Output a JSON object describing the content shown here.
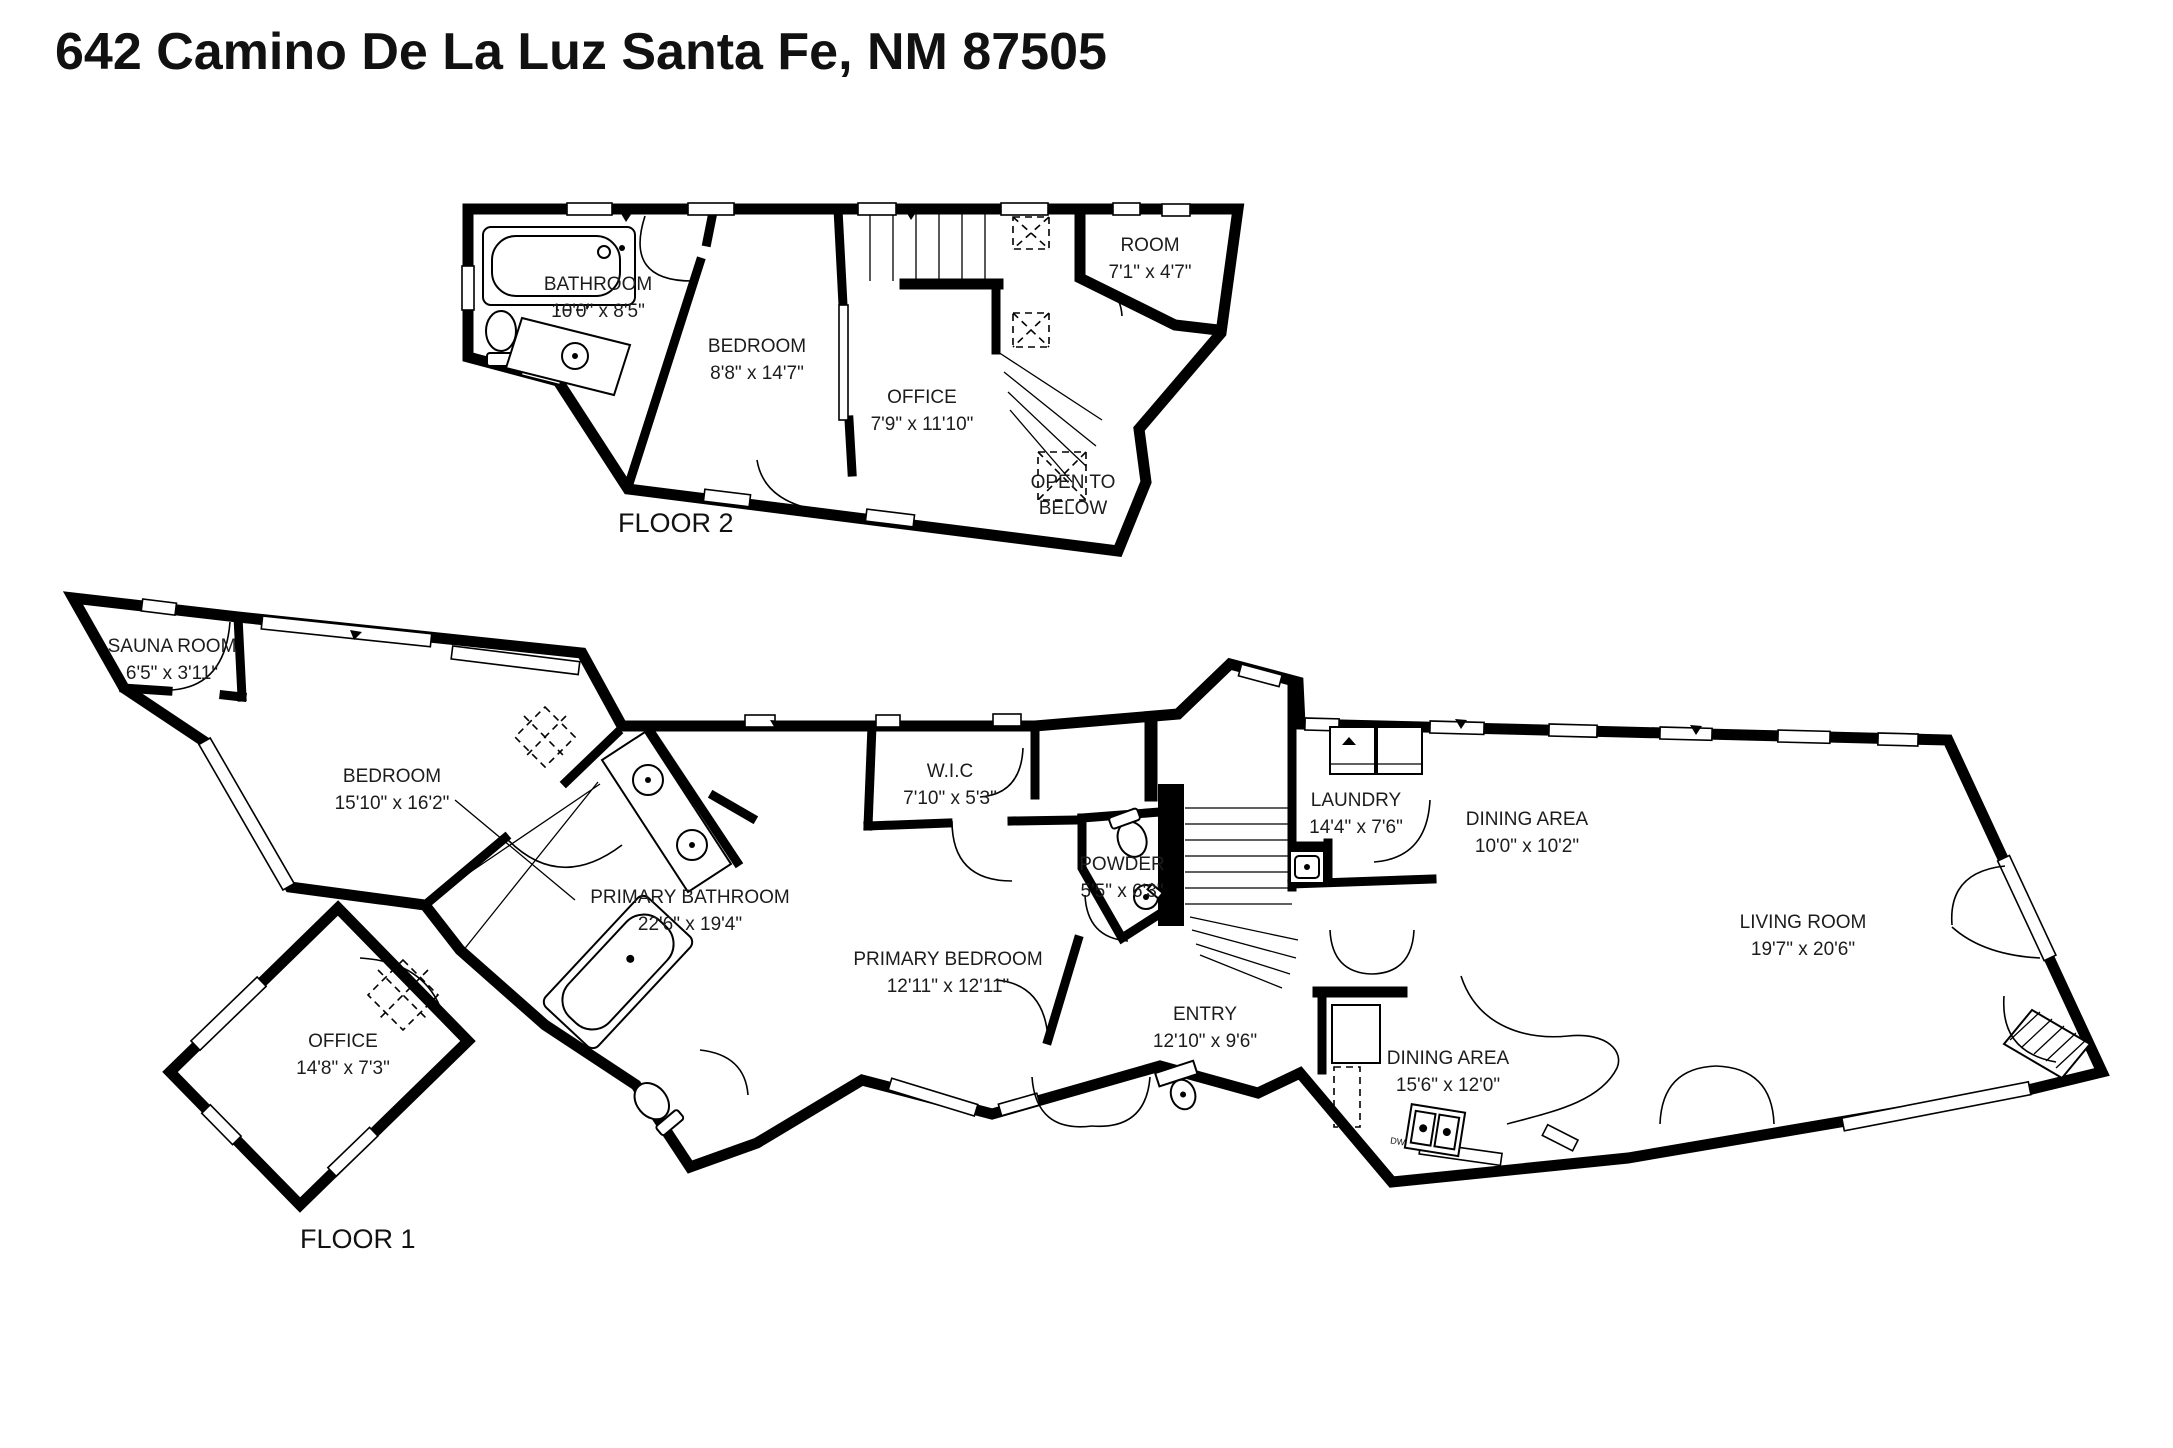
{
  "title": "642 Camino De La Luz Santa Fe, NM 87505",
  "floors": [
    {
      "label": "FLOOR 2",
      "rooms": [
        {
          "name": "BATHROOM",
          "dims": "10'0\" x 8'5\""
        },
        {
          "name": "BEDROOM",
          "dims": "8'8\" x 14'7\""
        },
        {
          "name": "OFFICE",
          "dims": "7'9\" x 11'10\""
        },
        {
          "name": "ROOM",
          "dims": "7'1\" x 4'7\""
        }
      ],
      "annotations": [
        {
          "line1": "OPEN TO",
          "line2": "BELOW"
        }
      ]
    },
    {
      "label": "FLOOR 1",
      "rooms": [
        {
          "name": "SAUNA ROOM",
          "dims": "6'5\" x 3'11\""
        },
        {
          "name": "BEDROOM",
          "dims": "15'10\" x 16'2\""
        },
        {
          "name": "PRIMARY BATHROOM",
          "dims": "22'6\" x 19'4\""
        },
        {
          "name": "OFFICE",
          "dims": "14'8\" x 7'3\""
        },
        {
          "name": "W.I.C",
          "dims": "7'10\" x 5'3\""
        },
        {
          "name": "PRIMARY BEDROOM",
          "dims": "12'11\" x 12'11\""
        },
        {
          "name": "POWDER",
          "dims": "5'5\" x 6'3\""
        },
        {
          "name": "ENTRY",
          "dims": "12'10\" x 9'6\""
        },
        {
          "name": "LAUNDRY",
          "dims": "14'4\" x 7'6\""
        },
        {
          "name": "DINING AREA",
          "dims": "10'0\" x 10'2\""
        },
        {
          "name": "DINING AREA",
          "dims": "15'6\" x 12'0\""
        },
        {
          "name": "LIVING ROOM",
          "dims": "19'7\" x 20'6\""
        }
      ]
    }
  ],
  "fixtures": {
    "dw_label": "DW"
  },
  "colors": {
    "walls": "#000000",
    "background": "#ffffff",
    "text": "#1c1c1c"
  }
}
